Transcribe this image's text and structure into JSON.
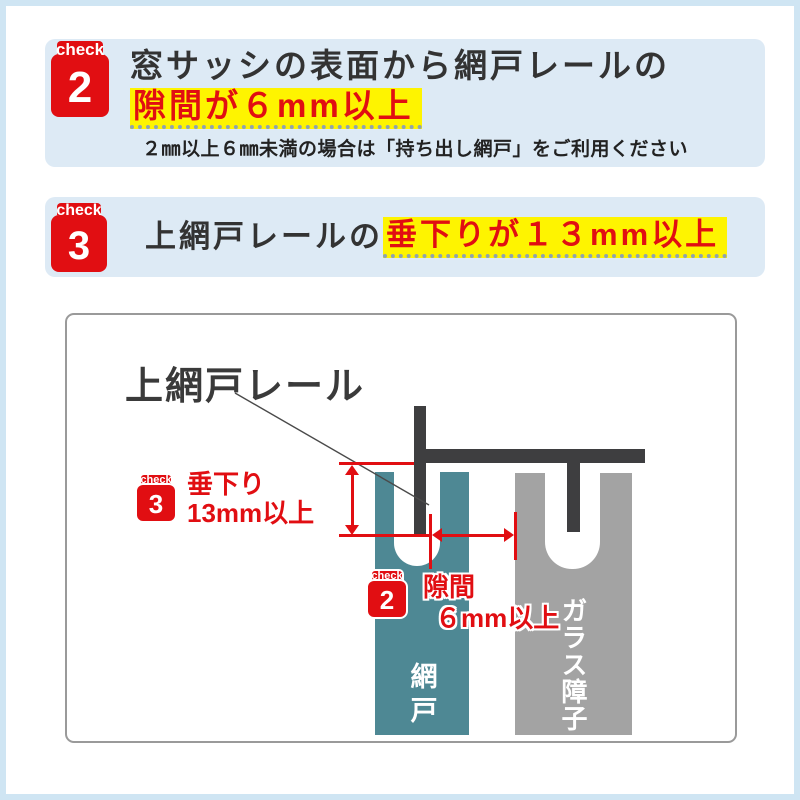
{
  "colors": {
    "red": "#e10e12",
    "section_bg": "#ddeaf5",
    "frame": "#cfe5f3",
    "yellow": "#fef400",
    "dark_text": "#333333",
    "rail": "#3e3e40",
    "screen_teal": "#4e8894",
    "shoji_gray": "#a3a3a3"
  },
  "check2_section": {
    "badge_label": "check",
    "badge_number": "2",
    "heading_plain": "窓サッシの表面から網戸レールの",
    "heading_highlight": "隙間が６mm以上",
    "note": "２㎜以上６㎜未満の場合は「持ち出し網戸」をご利用ください"
  },
  "check3_section": {
    "badge_label": "check",
    "badge_number": "3",
    "heading_plain": "上網戸レールの",
    "heading_highlight": "垂下りが１３mm以上"
  },
  "diagram": {
    "rail_label": "上網戸レール",
    "sag_annotation": {
      "badge_label": "check",
      "badge_number": "3",
      "line1": "垂下り",
      "line2": "13mm以上"
    },
    "gap_annotation": {
      "badge_label": "check",
      "badge_number": "2",
      "line1": "隙間",
      "line2": "６mm以上"
    },
    "screen_door_label": "網戸",
    "glass_shoji_label": "ガラス障子"
  }
}
